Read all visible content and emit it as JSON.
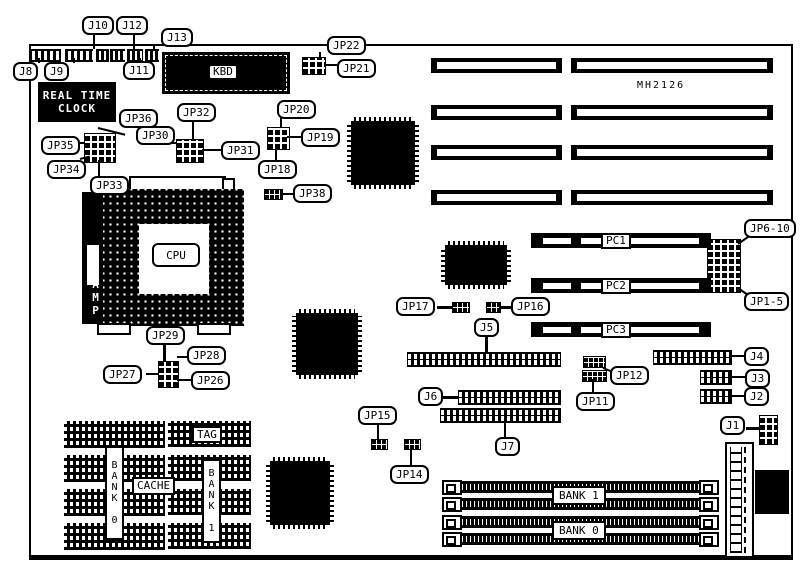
{
  "diagram": {
    "board_model": "MH2126",
    "callouts": {
      "j1": "J1",
      "j2": "J2",
      "j3": "J3",
      "j4": "J4",
      "j5": "J5",
      "j6": "J6",
      "j7": "J7",
      "j8": "J8",
      "j9": "J9",
      "j10": "J10",
      "j11": "J11",
      "j12": "J12",
      "j13": "J13",
      "jp11": "JP11",
      "jp12": "JP12",
      "jp14": "JP14",
      "jp15": "JP15",
      "jp16": "JP16",
      "jp17": "JP17",
      "jp18": "JP18",
      "jp19": "JP19",
      "jp20": "JP20",
      "jp21": "JP21",
      "jp22": "JP22",
      "jp26": "JP26",
      "jp27": "JP27",
      "jp28": "JP28",
      "jp29": "JP29",
      "jp30": "JP30",
      "jp31": "JP31",
      "jp32": "JP32",
      "jp33": "JP33",
      "jp34": "JP34",
      "jp35": "JP35",
      "jp36": "JP36",
      "jp38": "JP38",
      "jp1_5": "JP1-5",
      "jp6_10": "JP6-10"
    },
    "components": {
      "kbd": "KBD",
      "cpu": "CPU",
      "cpu_socket_brand": "AMP",
      "rtc_line1": "REAL TIME",
      "rtc_line2": "CLOCK",
      "pci_slots": [
        "PC1",
        "PC2",
        "PC3"
      ],
      "cache": {
        "tag": "TAG",
        "cache": "CACHE",
        "bank0": "BANK 0",
        "bank1": "BANK 1"
      },
      "memory": {
        "bank1": "BANK 1",
        "bank0": "BANK 0"
      }
    }
  }
}
